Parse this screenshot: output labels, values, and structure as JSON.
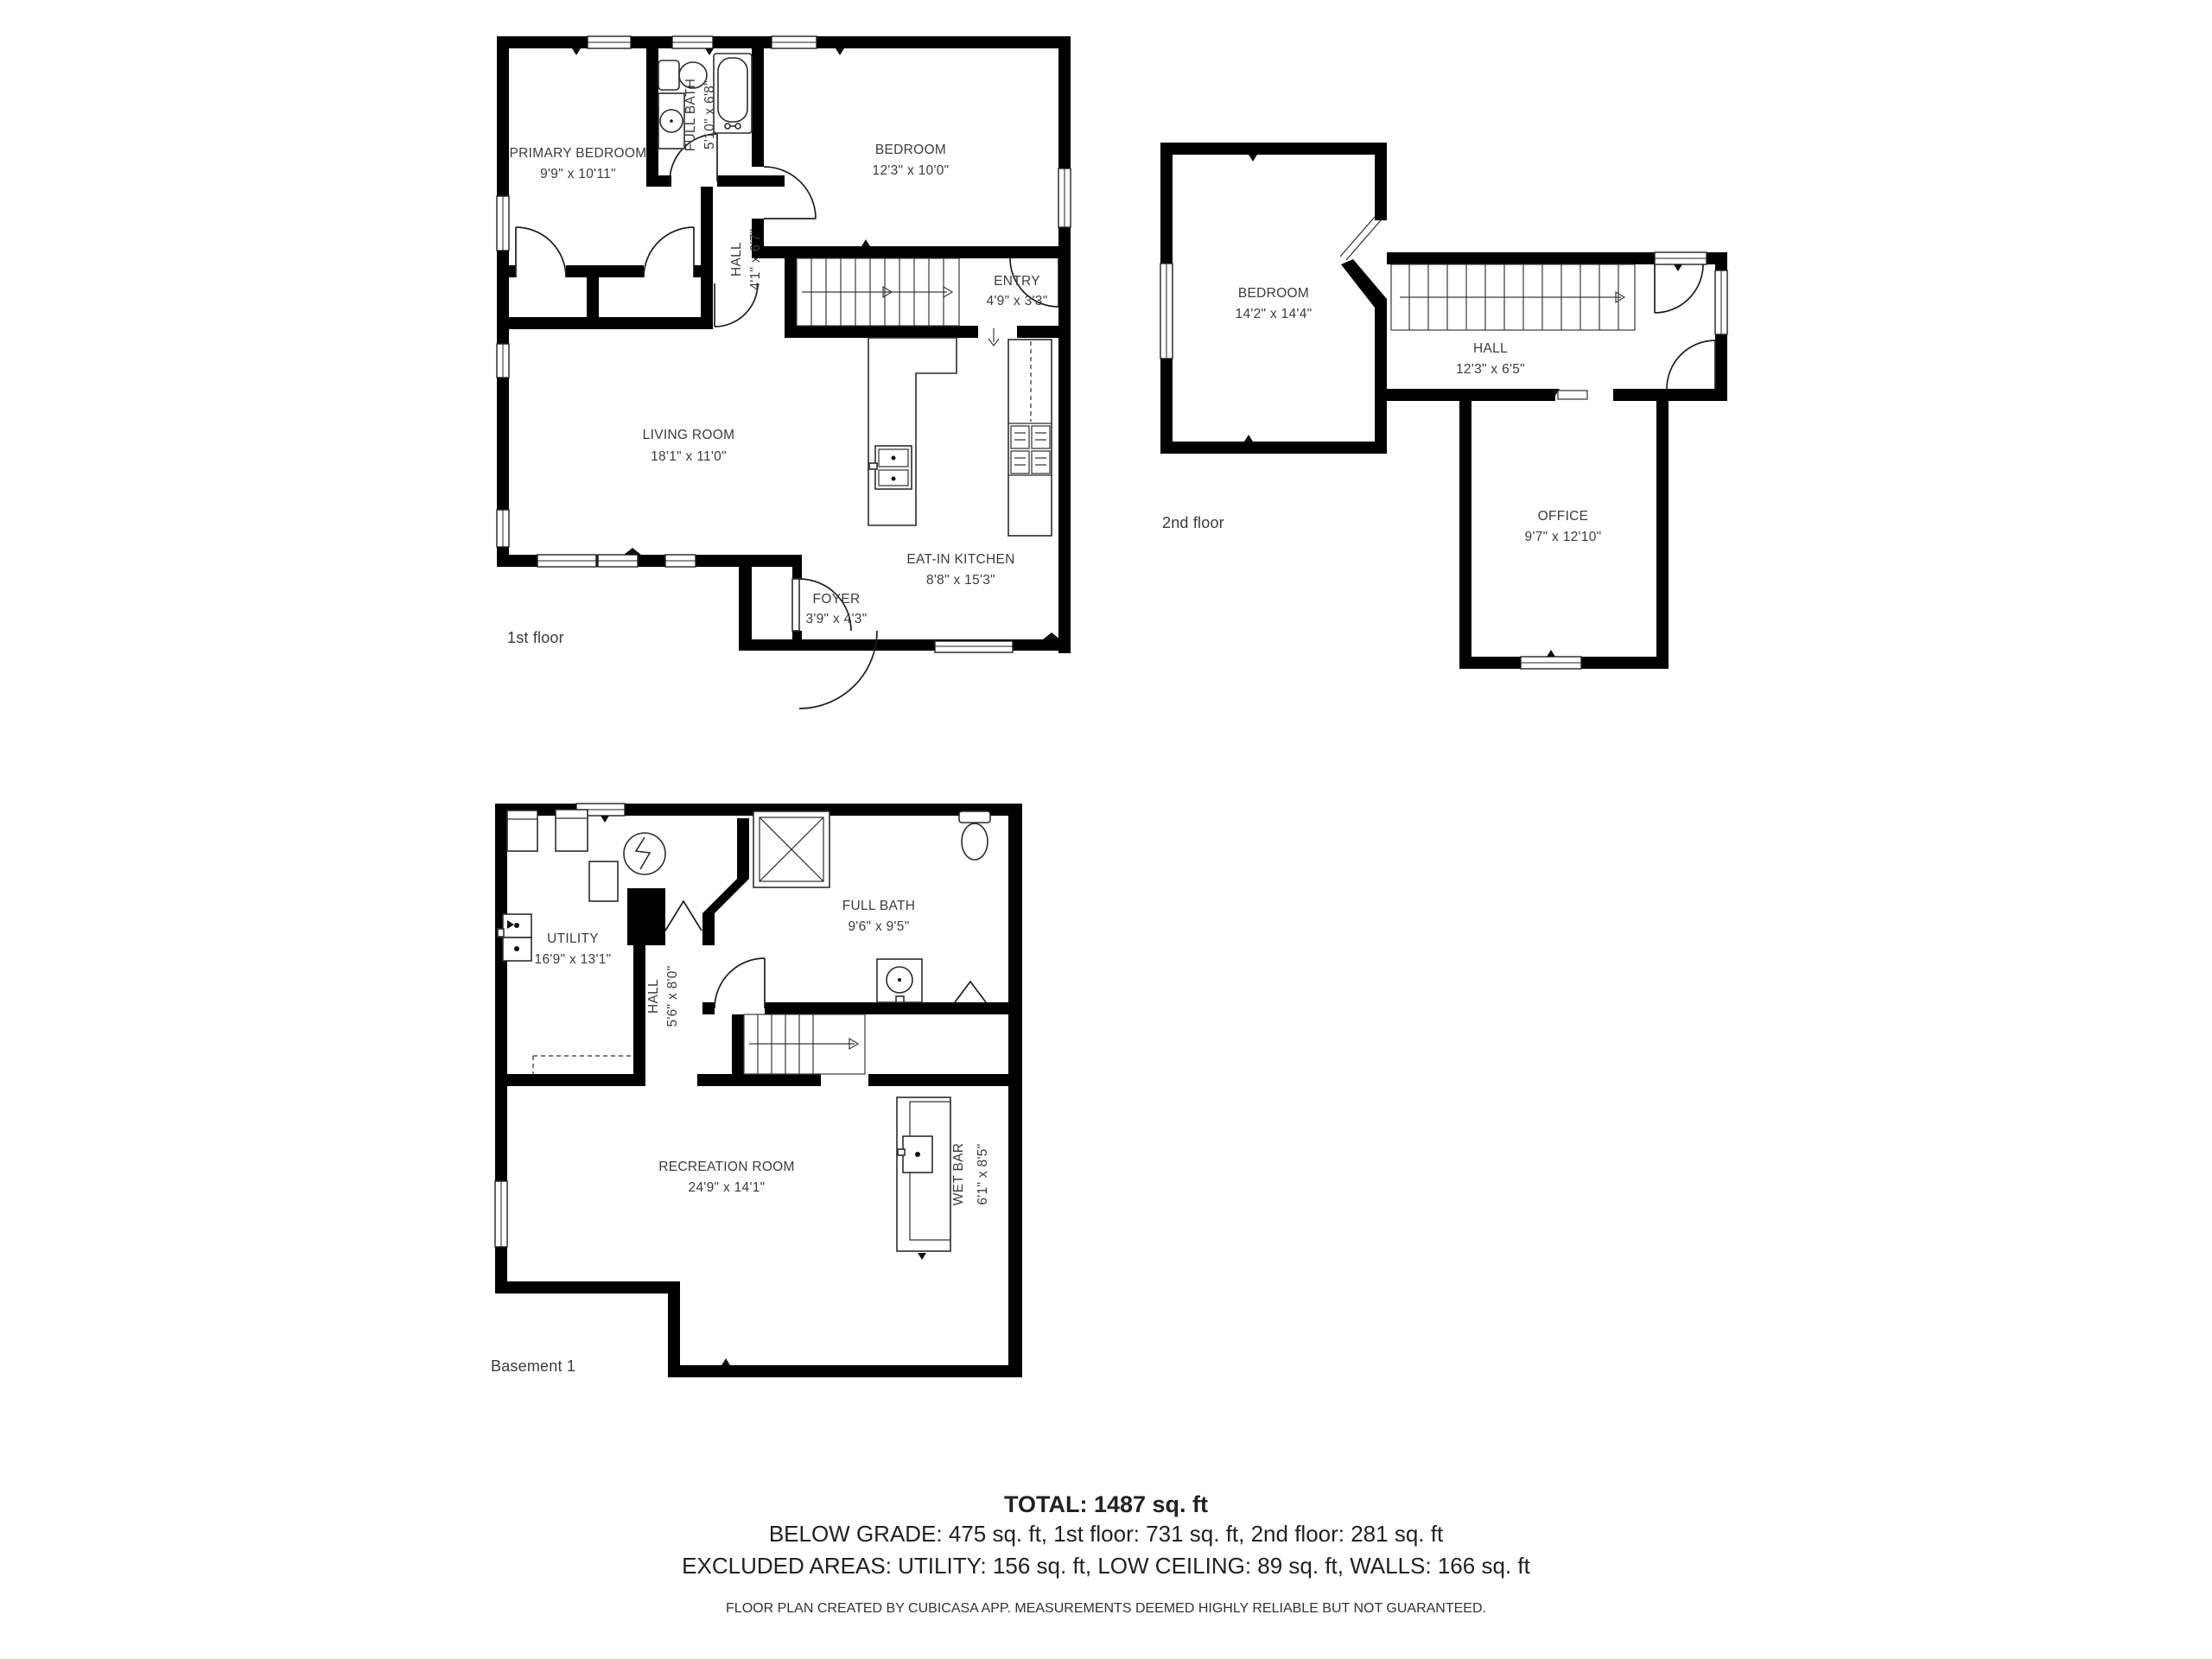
{
  "floors": [
    {
      "label": "1st floor",
      "rooms": [
        {
          "name": "PRIMARY BEDROOM",
          "dims": "9'9\" x 10'11\""
        },
        {
          "name": "FULL BATH",
          "dims": "5'10\" x 6'8\""
        },
        {
          "name": "BEDROOM",
          "dims": "12'3\" x 10'0\""
        },
        {
          "name": "HALL",
          "dims": "4'1\" x 6'7\""
        },
        {
          "name": "ENTRY",
          "dims": "4'9\" x 3'3\""
        },
        {
          "name": "LIVING ROOM",
          "dims": "18'1\" x 11'0\""
        },
        {
          "name": "EAT-IN KITCHEN",
          "dims": "8'8\" x 15'3\""
        },
        {
          "name": "FOYER",
          "dims": "3'9\" x 4'3\""
        }
      ]
    },
    {
      "label": "2nd floor",
      "rooms": [
        {
          "name": "BEDROOM",
          "dims": "14'2\" x 14'4\""
        },
        {
          "name": "HALL",
          "dims": "12'3\" x 6'5\""
        },
        {
          "name": "OFFICE",
          "dims": "9'7\" x 12'10\""
        }
      ]
    },
    {
      "label": "Basement 1",
      "rooms": [
        {
          "name": "UTILITY",
          "dims": "16'9\" x 13'1\""
        },
        {
          "name": "HALL",
          "dims": "5'6\" x 8'0\""
        },
        {
          "name": "FULL BATH",
          "dims": "9'6\" x 9'5\""
        },
        {
          "name": "RECREATION ROOM",
          "dims": "24'9\" x 14'1\""
        },
        {
          "name": "WET BAR",
          "dims": "6'1\" x 8'5\""
        }
      ]
    }
  ],
  "summary": {
    "total": "TOTAL: 1487 sq. ft",
    "below_grade": "BELOW GRADE: 475 sq. ft, 1st floor: 731 sq. ft, 2nd floor: 281 sq. ft",
    "excluded": "EXCLUDED AREAS: UTILITY: 156 sq. ft, LOW CEILING: 89 sq. ft, WALLS: 166 sq. ft"
  },
  "footer": "FLOOR PLAN CREATED BY CUBICASA APP. MEASUREMENTS DEEMED HIGHLY RELIABLE BUT NOT GUARANTEED."
}
